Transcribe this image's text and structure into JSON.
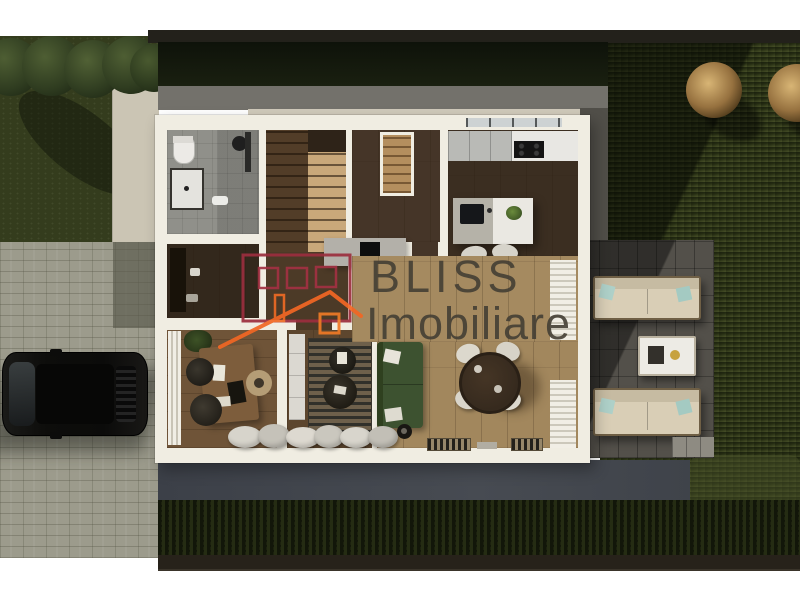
{
  "watermark": {
    "brand": "BLISS",
    "brand_secondary": "Imobiliare",
    "logo_icon": "house-outline-logo",
    "logo_red": "#9c2e3e",
    "logo_orange": "#f26724",
    "text_color": "#47423a"
  },
  "scene": {
    "type": "top-down-3d-floor-plan-render",
    "palette": {
      "background": "#ffffff",
      "fence": "#23211b",
      "hedge": "#141a0e",
      "grass_left": "#343c1d",
      "grass_right_dark": "#1d240f",
      "grass_right_light": "#474f28",
      "pavers": "#9c9b8c",
      "concrete_pad": "#cbc5b4",
      "path_gray": "#73716b",
      "path_blue": "#42464e",
      "deck": "#53504a",
      "walls": "#f0ede2",
      "floor_dark": "#46362a",
      "floor_light": "#a58a60",
      "stairs_light": "#c9a87a",
      "bathroom_tile": "#90908a",
      "sofa_green": "#3d5230",
      "dining_table": "#362a1e",
      "chair_white": "#dcd8cd",
      "outdoor_sofa": "#d9ceb6",
      "pillow_teal": "#aed0c8",
      "car_black": "#0d0d0b",
      "tree_green": "#3a4a28",
      "tree_copper": "#96713f"
    },
    "depicted_objects": [
      "bathroom",
      "staircase",
      "entry-shelf-closet",
      "kitchen-counter",
      "kitchen-island",
      "bar-stools",
      "dining-table",
      "dining-chairs",
      "green-sofa",
      "tv-lounge-rug",
      "poufs",
      "office-desk",
      "desk-chairs",
      "window-seat-cushions",
      "wall-curtains",
      "terrace-sofas",
      "terrace-coffee-table",
      "stepping-pad",
      "parked-car",
      "paver-driveway",
      "concrete-paths",
      "lawn",
      "hedge",
      "green-trees",
      "copper-trees",
      "fence"
    ]
  }
}
